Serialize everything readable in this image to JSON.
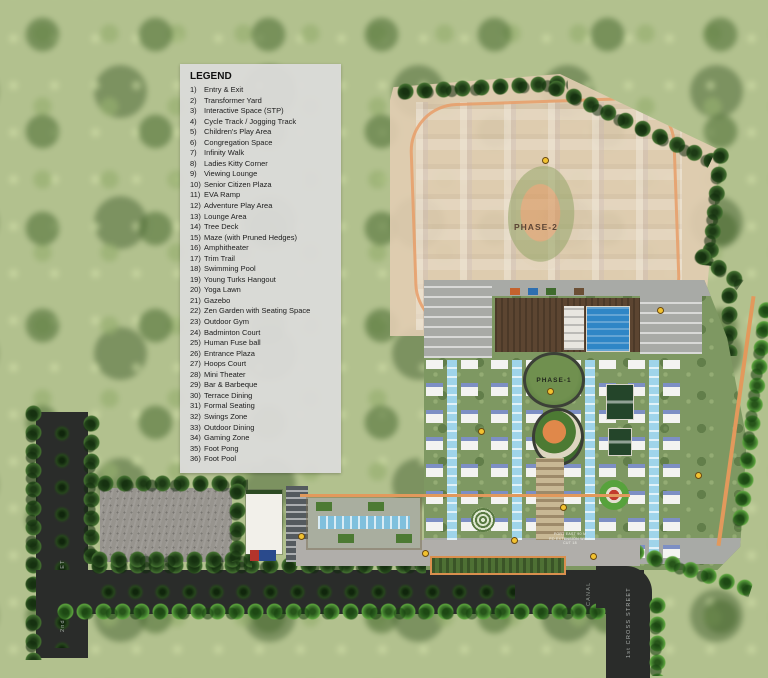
{
  "legend": {
    "title": "LEGEND",
    "items": [
      {
        "num": "1)",
        "label": "Entry & Exit"
      },
      {
        "num": "2)",
        "label": "Transformer Yard"
      },
      {
        "num": "3)",
        "label": "Interactive Space (STP)"
      },
      {
        "num": "4)",
        "label": "Cycle Track / Jogging Track"
      },
      {
        "num": "5)",
        "label": "Children's Play Area"
      },
      {
        "num": "6)",
        "label": "Congregation Space"
      },
      {
        "num": "7)",
        "label": "Infinity Walk"
      },
      {
        "num": "8)",
        "label": "Ladies Kitty Corner"
      },
      {
        "num": "9)",
        "label": "Viewing Lounge"
      },
      {
        "num": "10)",
        "label": "Senior Citizen Plaza"
      },
      {
        "num": "11)",
        "label": "EVA Ramp"
      },
      {
        "num": "12)",
        "label": "Adventure Play Area"
      },
      {
        "num": "13)",
        "label": "Lounge Area"
      },
      {
        "num": "14)",
        "label": "Tree Deck"
      },
      {
        "num": "15)",
        "label": "Maze (with Pruned Hedges)"
      },
      {
        "num": "16)",
        "label": "Amphitheater"
      },
      {
        "num": "17)",
        "label": "Trim Trail"
      },
      {
        "num": "18)",
        "label": "Swimming Pool"
      },
      {
        "num": "19)",
        "label": "Young Turks Hangout"
      },
      {
        "num": "20)",
        "label": "Yoga Lawn"
      },
      {
        "num": "21)",
        "label": "Gazebo"
      },
      {
        "num": "22)",
        "label": "Zen Garden with Seating Space"
      },
      {
        "num": "23)",
        "label": "Outdoor Gym"
      },
      {
        "num": "24)",
        "label": "Badminton Court"
      },
      {
        "num": "25)",
        "label": "Human Fuse ball"
      },
      {
        "num": "26)",
        "label": "Entrance Plaza"
      },
      {
        "num": "27)",
        "label": "Hoops Court"
      },
      {
        "num": "28)",
        "label": "Mini Theater"
      },
      {
        "num": "29)",
        "label": "Bar & Barbeque"
      },
      {
        "num": "30)",
        "label": "Terrace Dining"
      },
      {
        "num": "31)",
        "label": "Formal Seating"
      },
      {
        "num": "32)",
        "label": "Swings Zone"
      },
      {
        "num": "33)",
        "label": "Outdoor Dining"
      },
      {
        "num": "34)",
        "label": "Gaming Zone"
      },
      {
        "num": "35)",
        "label": "Foot Pong"
      },
      {
        "num": "36)",
        "label": "Foot Pool"
      }
    ]
  },
  "map": {
    "phase1_label": "PHASE-1",
    "phase2_label": "PHASE-2",
    "streets": {
      "left": "2nd CROSS STREET",
      "right": "1st CROSS STREET",
      "canal": "CANAL"
    },
    "road_note": [
      "PORT EAST 90 M",
      "RD EXTENSION WALL",
      "CUT 18"
    ]
  },
  "colors": {
    "track_orange": "#E2995C",
    "pool_blue": "#2F86C6",
    "road_dark": "#2A2C2A",
    "phase2_wash": "#E2CDB2",
    "lawn_green": "#7E9862",
    "tree_dark": "#2F5423",
    "legend_bg": "#DBDBD9",
    "marker_yellow": "#F2C230"
  }
}
